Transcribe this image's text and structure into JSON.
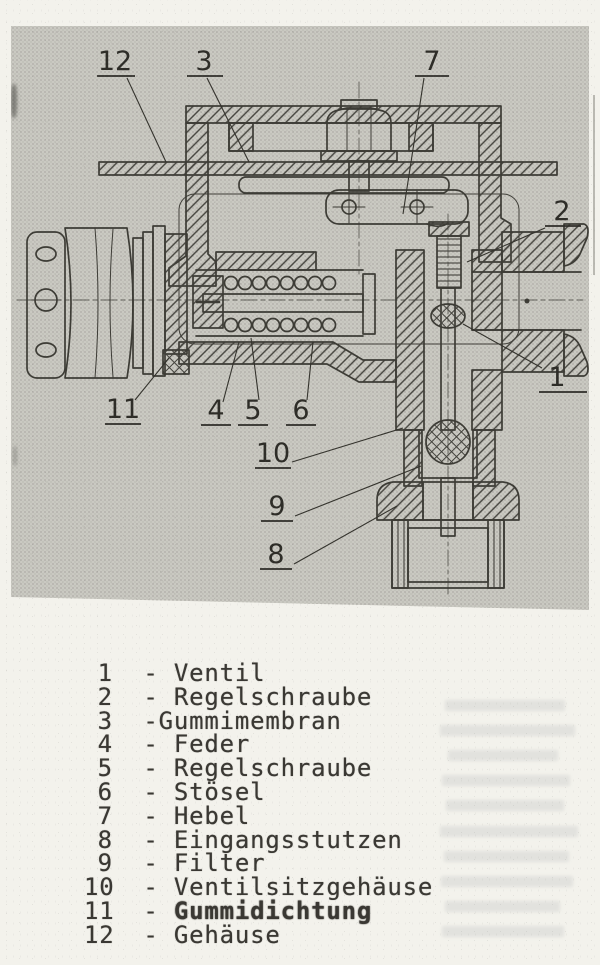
{
  "page": {
    "background": "#f3f2ec",
    "photo_background": "#cac9c2",
    "ink_color": "#33322c"
  },
  "figure": {
    "type": "technical-cross-section",
    "callouts": [
      {
        "label": "12",
        "x": 104,
        "y": 44,
        "ul": [
          86,
          124,
          50
        ],
        "leader": [
          116,
          52,
          155,
          136
        ]
      },
      {
        "label": "3",
        "x": 193,
        "y": 44,
        "ul": [
          176,
          212,
          50
        ],
        "leader": [
          196,
          52,
          238,
          136
        ]
      },
      {
        "label": "7",
        "x": 421,
        "y": 44,
        "ul": [
          404,
          438,
          50
        ],
        "leader": [
          413,
          52,
          392,
          188
        ]
      },
      {
        "label": "2",
        "x": 551,
        "y": 194,
        "ul": [
          534,
          570,
          200
        ],
        "leader": [
          534,
          202,
          456,
          236
        ]
      },
      {
        "label": "1",
        "x": 546,
        "y": 360,
        "ul": [
          528,
          576,
          366
        ],
        "leader": [
          531,
          342,
          452,
          298
        ]
      },
      {
        "label": "11",
        "x": 112,
        "y": 392,
        "ul": [
          94,
          130,
          398
        ],
        "leader": [
          124,
          374,
          158,
          332
        ]
      },
      {
        "label": "4",
        "x": 205,
        "y": 393,
        "ul": [
          190,
          220,
          399
        ],
        "leader": [
          212,
          376,
          228,
          316
        ]
      },
      {
        "label": "5",
        "x": 242,
        "y": 393,
        "ul": [
          227,
          257,
          399
        ],
        "leader": [
          248,
          374,
          240,
          312
        ]
      },
      {
        "label": "6",
        "x": 290,
        "y": 393,
        "ul": [
          275,
          305,
          399
        ],
        "leader": [
          296,
          374,
          302,
          316
        ]
      },
      {
        "label": "10",
        "x": 262,
        "y": 436,
        "ul": [
          244,
          280,
          442
        ],
        "leader": [
          281,
          436,
          392,
          402
        ]
      },
      {
        "label": "9",
        "x": 266,
        "y": 489,
        "ul": [
          250,
          282,
          495
        ],
        "leader": [
          284,
          490,
          410,
          440
        ]
      },
      {
        "label": "8",
        "x": 265,
        "y": 537,
        "ul": [
          249,
          281,
          543
        ],
        "leader": [
          283,
          538,
          386,
          480
        ]
      }
    ]
  },
  "legend": {
    "items": [
      {
        "number": "1",
        "sep": "  - ",
        "label": "Ventil"
      },
      {
        "number": "2",
        "sep": "  - ",
        "label": "Regelschraube"
      },
      {
        "number": "3",
        "sep": "  -",
        "label": "Gummimembran"
      },
      {
        "number": "4",
        "sep": "  - ",
        "label": "Feder"
      },
      {
        "number": "5",
        "sep": "  - ",
        "label": "Regelschraube"
      },
      {
        "number": "6",
        "sep": "  - ",
        "label": "Stösel"
      },
      {
        "number": "7",
        "sep": "  - ",
        "label": "Hebel"
      },
      {
        "number": "8",
        "sep": "  - ",
        "label": "Eingangsstutzen"
      },
      {
        "number": "9",
        "sep": "  - ",
        "label": "Filter"
      },
      {
        "number": "10",
        "sep": "  - ",
        "label": "Ventilsitzgehäuse"
      },
      {
        "number": "11",
        "sep": "  - ",
        "label": "Gummidichtung",
        "smudged": true
      },
      {
        "number": "12",
        "sep": "  - ",
        "label": "Gehäuse"
      }
    ]
  }
}
